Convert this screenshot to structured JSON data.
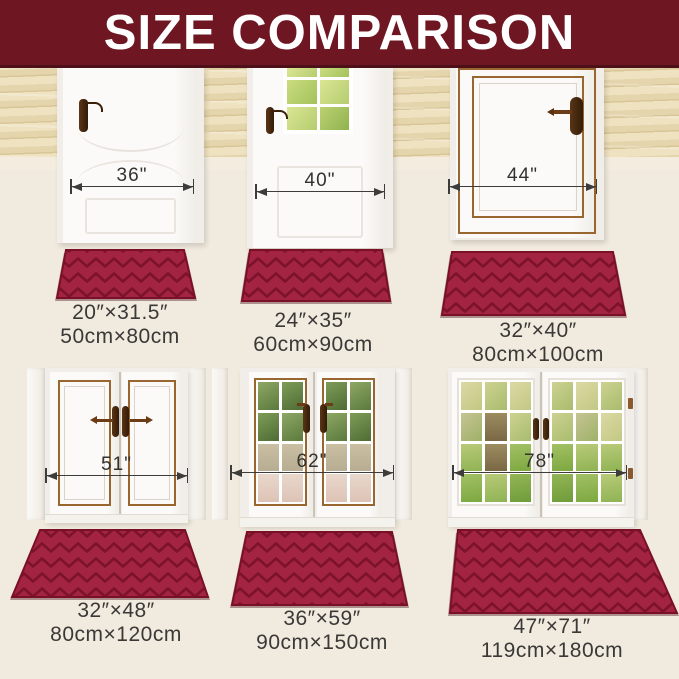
{
  "banner": {
    "title": "SIZE COMPARISON"
  },
  "colors": {
    "banner_bg": "#6E1621",
    "banner_text": "#FFFFFF",
    "wall": "#F1EADE",
    "baseboard": "#F6F3ED",
    "mat": "#A32442",
    "mat_groove": "#7C122B",
    "mat_edge": "#7A1028",
    "label_text": "#3A3937",
    "arrow": "#3D3C3A",
    "door_trim_brown": "#9A6630",
    "handle_brown": "#5A3010"
  },
  "panels": [
    {
      "door_width_label": "36\"",
      "size_in": "20″×31.5″",
      "size_cm": "50cm×80cm"
    },
    {
      "door_width_label": "40\"",
      "size_in": "24″×35″",
      "size_cm": "60cm×90cm"
    },
    {
      "door_width_label": "44\"",
      "size_in": "32″×40″",
      "size_cm": "80cm×100cm"
    },
    {
      "door_width_label": "51\"",
      "size_in": "32″×48″",
      "size_cm": "80cm×120cm"
    },
    {
      "door_width_label": "62\"",
      "size_in": "36″×59″",
      "size_cm": "90cm×150cm"
    },
    {
      "door_width_label": "78\"",
      "size_in": "47″×71″",
      "size_cm": "119cm×180cm"
    }
  ]
}
